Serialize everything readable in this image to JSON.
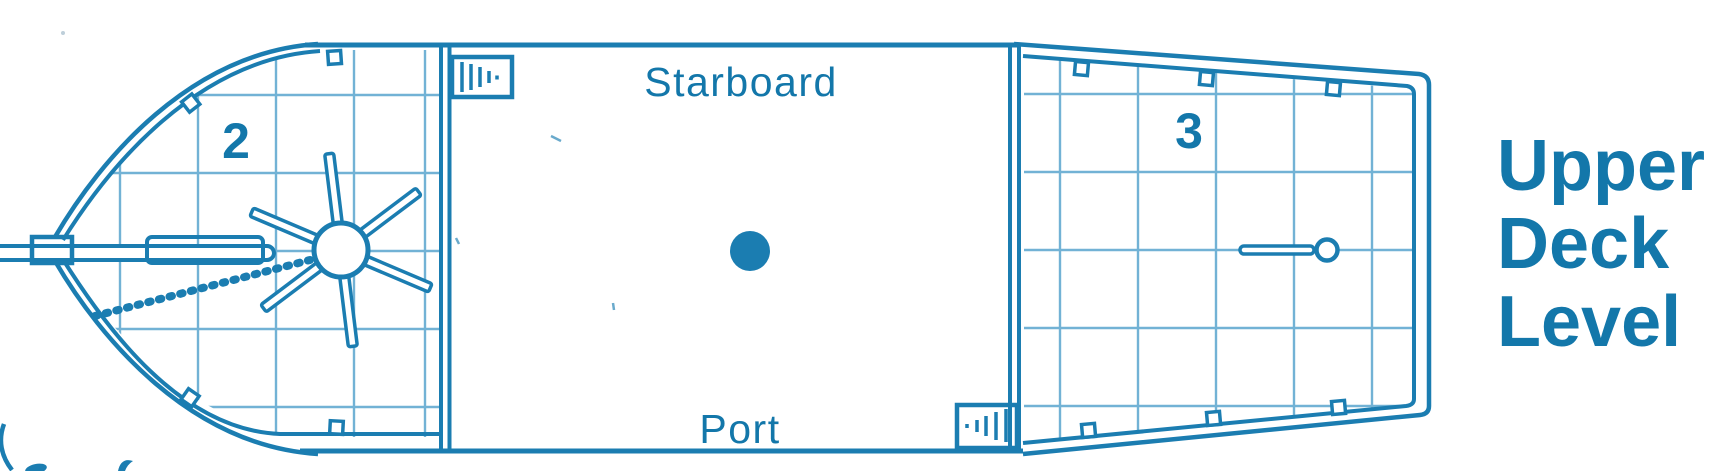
{
  "diagram": {
    "type": "ship deck plan",
    "labels": {
      "starboard": "Starboard",
      "port": "Port",
      "bow_compartment": "2",
      "stern_compartment": "3",
      "deck_title_lines": [
        "Upper",
        "Deck",
        "Level"
      ]
    },
    "features": [
      "bowsprit",
      "gammon-iron-collar",
      "bowsprit-heel",
      "anchor-chain",
      "capstan-with-six-bars",
      "mast-position-dot",
      "tiller",
      "companionway-ladder-forward",
      "companionway-ladder-aft",
      "deck-grating-grid-bow",
      "deck-grating-grid-stern",
      "deck-cleats"
    ]
  },
  "colors": {
    "line": "#1b7db1",
    "grid": "#63aad1",
    "text": "#1377aa",
    "paper": "#ffffff"
  }
}
